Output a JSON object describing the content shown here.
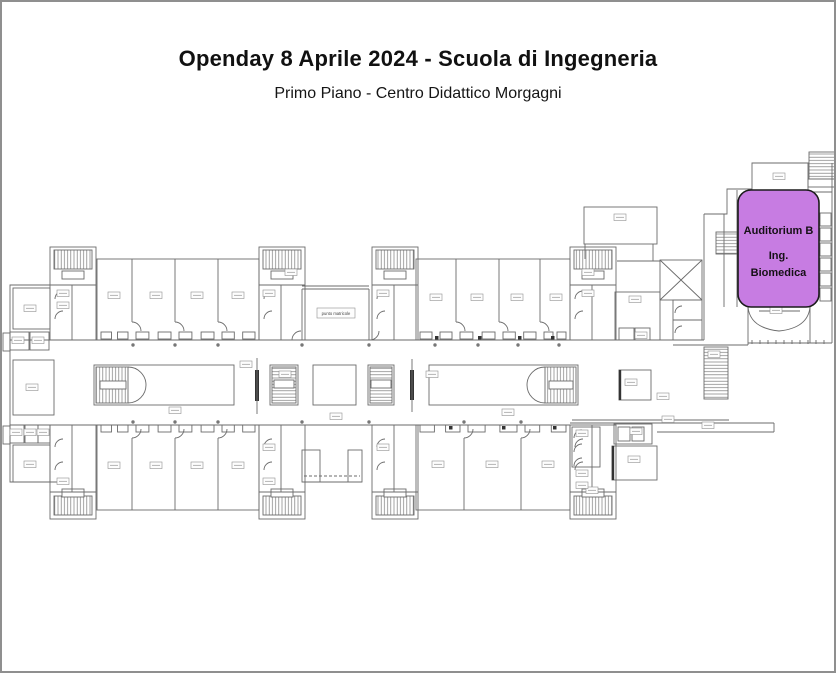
{
  "header": {
    "title": "Openday 8 Aprile 2024 - Scuola di Ingegneria",
    "subtitle": "Primo Piano - Centro Didattico Morgagni"
  },
  "floorplan": {
    "corridor_label": "punto matricole"
  },
  "highlight": {
    "title": "Auditorium B",
    "dept_line1": "Ing.",
    "dept_line2": "Biomedica",
    "fill": "#c77ce2",
    "border_color": "#1c1c1c"
  },
  "colors": {
    "wall": "#6b6b6b",
    "page_border": "#8f8f8f"
  }
}
